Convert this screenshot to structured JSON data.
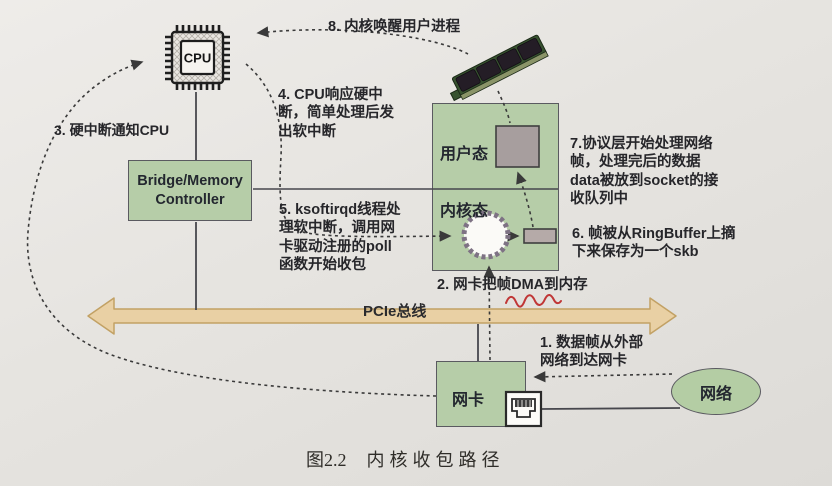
{
  "figure": {
    "caption_number": "图2.2",
    "caption_title": "内核收包路径"
  },
  "nodes": {
    "cpu": {
      "label": "CPU"
    },
    "bridge": {
      "line1": "Bridge/Memory",
      "line2": "Controller"
    },
    "user_mode": {
      "label": "用户态"
    },
    "kernel_mode": {
      "label": "内核态"
    },
    "nic": {
      "label": "网卡"
    },
    "network": {
      "label": "网络"
    },
    "pcie": {
      "label": "PCIe总线"
    }
  },
  "steps": {
    "s1": {
      "lines": [
        "1. 数据帧从外部",
        "网络到达网卡"
      ]
    },
    "s2": {
      "lines": [
        "2. 网卡把帧DMA到内存"
      ]
    },
    "s3": {
      "lines": [
        "3. 硬中断通知CPU"
      ]
    },
    "s4": {
      "lines": [
        "4. CPU响应硬中",
        "断，简单处理后发",
        "出软中断"
      ]
    },
    "s5": {
      "lines": [
        "5. ksoftirqd线程处",
        "理软中断，调用网",
        "卡驱动注册的poll",
        "函数开始收包"
      ]
    },
    "s6": {
      "lines": [
        "6. 帧被从RingBuffer上摘",
        "下来保存为一个skb"
      ]
    },
    "s7": {
      "lines": [
        "7.协议层开始处理网络",
        "帧，处理完后的数据",
        "data被放到socket的接",
        "收队列中"
      ]
    },
    "s8": {
      "lines": [
        "8. 内核唤醒用户进程"
      ]
    }
  },
  "colors": {
    "box_green": "#b6cda8",
    "bus_tan": "#e9d0a4",
    "bus_border": "#c2a164",
    "underline_red": "#c03636",
    "paper": "#e6e4e0",
    "ink": "#26262a"
  }
}
